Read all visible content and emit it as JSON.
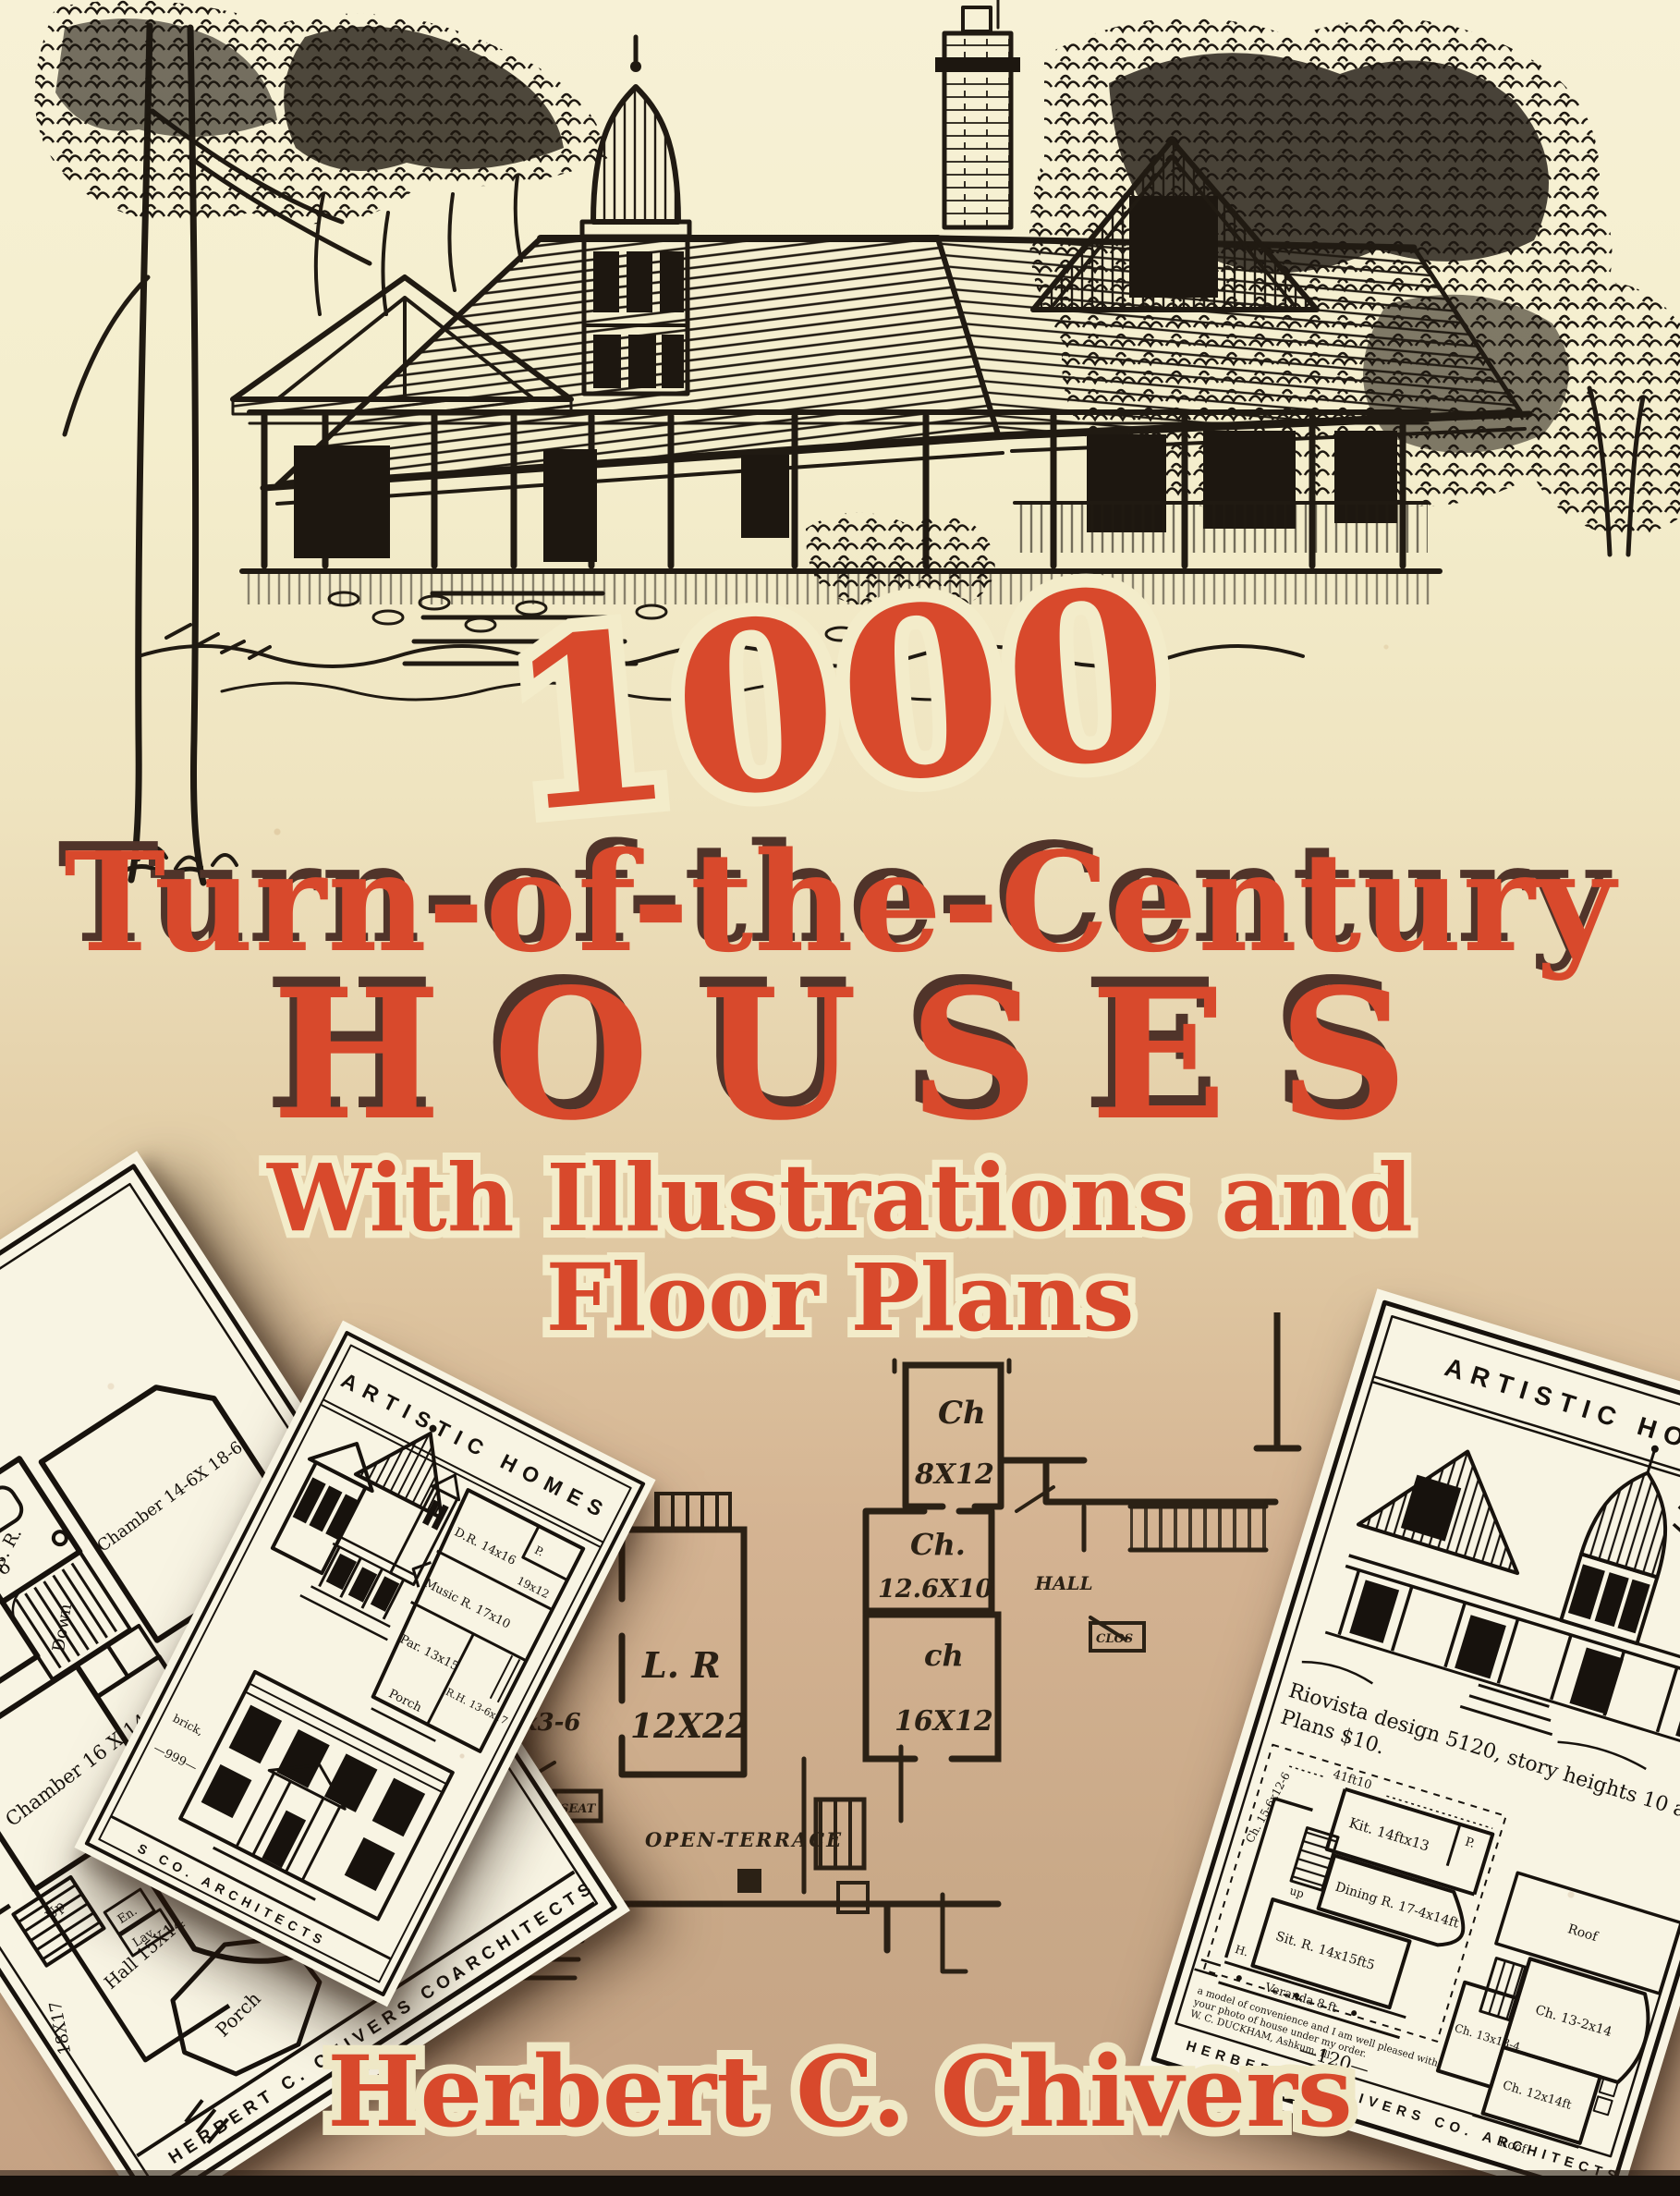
{
  "cover": {
    "title_number": "1000",
    "title_line1": "Turn-of-the-Century",
    "title_line2": "HOUSES",
    "subtitle_line1": "With Illustrations and",
    "subtitle_line2": "Floor Plans",
    "author": "Herbert C. Chivers",
    "colors": {
      "accent": "#d8492c",
      "outline_cream": "#f3ecca",
      "shadow_brown": "#50342a",
      "ink": "#201a12",
      "card_paper": "#f8f4e3"
    }
  },
  "left_card": {
    "price_note": "in frame, $2,980 to",
    "chamber1": "Chamber 16X16",
    "br": "B. R.",
    "down1": "Down",
    "chamber2": "Chamber 14-6X 18-6",
    "chamber3": "Chamber 16 X 14",
    "dres": "Dres. Rm.",
    "chamber4": "Chamber 18X14",
    "down2": "Down",
    "chamber5": "Chamber 15X12",
    "room": "Room 18X16",
    "dim1": "18X17",
    "up": "Up",
    "hall": "Hall 15X14",
    "en": "En.",
    "lav": "Lav.",
    "porch": "Porch",
    "plan_number": "—965—",
    "border_left": "HERBERT C. CHIVERS CO.",
    "border_right": "ARCHITECTS"
  },
  "middle_card": {
    "header": "ARTISTIC HOMES",
    "p": "P.",
    "dr": "D.R. 14x16",
    "k": "19x12",
    "music": "Music R. 17x10",
    "par": "Par. 13x15",
    "rh": "R.H. 13-6x17",
    "porch": "Porch",
    "note": "brick,",
    "page_number": "—999—",
    "border_text": "S CO.  ARCHITECTS"
  },
  "right_card": {
    "header": "ARTISTIC HOMES",
    "caption_line1": "Riovista design 5120, story heights 10 and 8 ft 6.",
    "caption_line2": "Plans $10.",
    "dimension": "41ft10",
    "kit": "Kit. 14ftx13",
    "p": "P.",
    "ch_left": "Ch. 15-6x12-6",
    "up": "up",
    "dining": "Dining R. 17-4x14ft",
    "sit": "Sit. R. 14x15ft5",
    "h": "H.",
    "veranda": "Veranda 8 ft",
    "roof_top": "Roof",
    "ch1": "Ch. 13-2x14",
    "ch2": "Ch. 13x13-4",
    "ch3": "Ch. 12x14ft",
    "roof_bottom": "Roof",
    "testimonial_line1": "a model of convenience and I am well pleased with",
    "testimonial_line2": "your photo of house under my order.",
    "testimonial_line3": "W. C. DUCKHAM, Ashkum, Ill.",
    "page_number": "—120—",
    "border_text": "HERBERT C. CHIVERS CO.   ARCHITECTS"
  },
  "center_plan": {
    "ch1": "Ch",
    "ch1_size": "8X12",
    "ch2": "Ch.",
    "ch2_size": "12.6X10",
    "ch3": "ch",
    "ch3_size": "16X12",
    "hall": "HALL",
    "lr": "L. R",
    "lr_size": "12X22",
    "terrace": "OPEN-TERRACE",
    "seat": "SEAT",
    "clos": "CLOS",
    "dim": "x3-6"
  }
}
